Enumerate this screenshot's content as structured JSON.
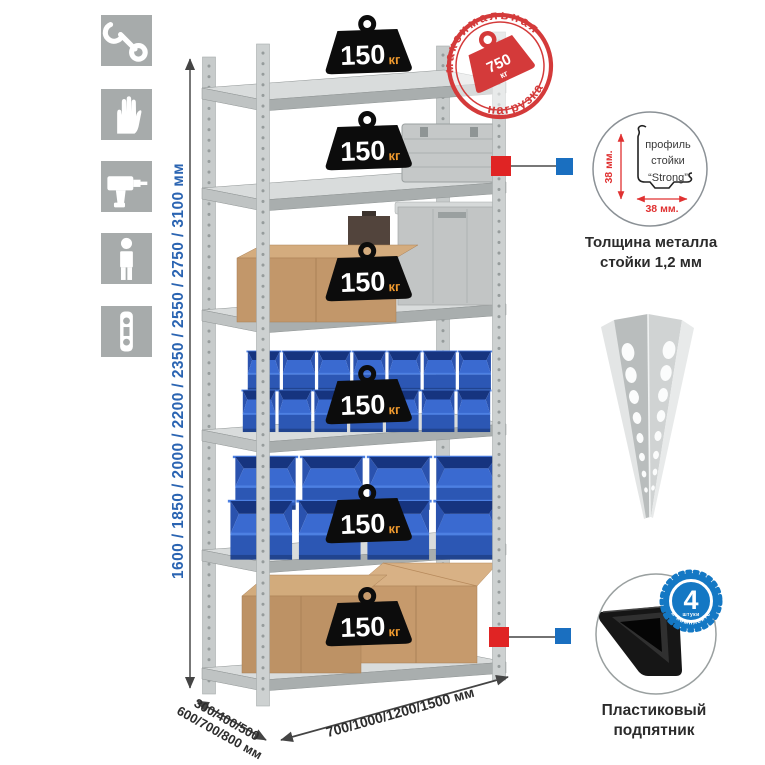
{
  "page": {
    "background": "#ffffff"
  },
  "left_toolbar": {
    "icons": [
      {
        "name": "wrench-icon"
      },
      {
        "name": "gloves-icon"
      },
      {
        "name": "drill-icon"
      },
      {
        "name": "person-icon"
      },
      {
        "name": "level-icon"
      }
    ]
  },
  "dimensions": {
    "height_label": "1600 / 1850 / 2000 / 2200 / 2350 / 2550 / 2750 / 3100 мм",
    "depth_label_line1": "300/400/500",
    "depth_label_line2": "600/700/800 мм",
    "width_label": "700/1000/1200/1500 мм"
  },
  "rack": {
    "shelf_count": 6,
    "shelf_weights": [
      {
        "value": "150",
        "unit": "кг"
      },
      {
        "value": "150",
        "unit": "кг"
      },
      {
        "value": "150",
        "unit": "кг"
      },
      {
        "value": "150",
        "unit": "кг"
      },
      {
        "value": "150",
        "unit": "кг"
      },
      {
        "value": "150",
        "unit": "кг"
      }
    ]
  },
  "max_load_stamp": {
    "arc_top": "максимальная",
    "arc_bottom": "нагрузка",
    "value": "750",
    "unit": "кг"
  },
  "profile_detail": {
    "label_line1": "профиль",
    "label_line2": "стойки",
    "label_line3": "“Strong”",
    "dim_vertical": "38 мм.",
    "dim_horizontal": "38 мм.",
    "caption_line1": "Толщина металла",
    "caption_line2": "стойки 1,2 мм"
  },
  "included_badge": {
    "count": "4",
    "count_unit": "штуки",
    "arc_text": "в комплекте"
  },
  "foot_detail": {
    "caption_line1": "Пластиковый",
    "caption_line2": "подпятник"
  },
  "colors": {
    "stamp_red": "#d43a3a",
    "marker_red": "#e02424",
    "marker_blue": "#1a6fc0",
    "dimension_blue": "#2a64b2",
    "weight_black": "#0c0c0c",
    "weight_unit_orange": "#f09a2e",
    "bin_blue": "#2f63c9",
    "icon_tile_gray": "#a7abab",
    "metal_gray": "#c7cbcb"
  }
}
